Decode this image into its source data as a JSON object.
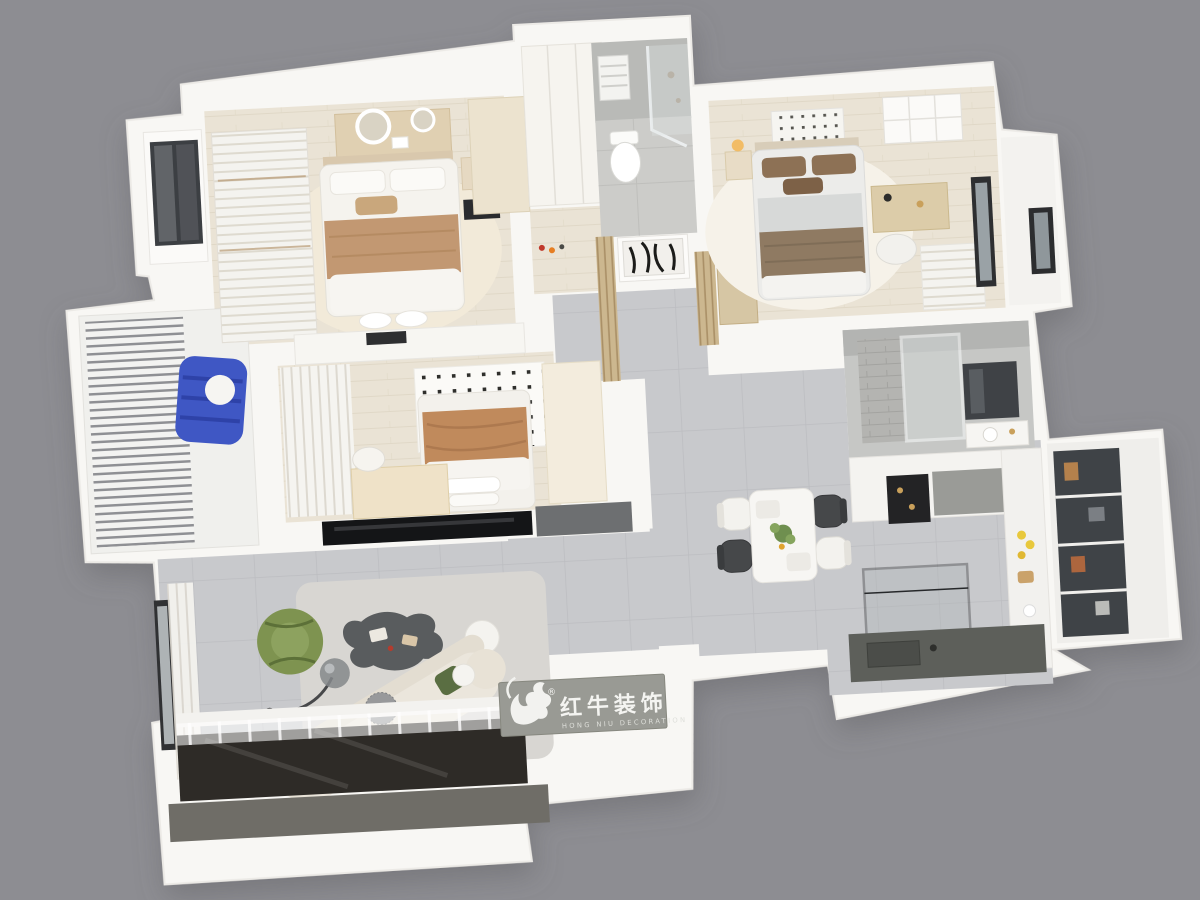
{
  "scene": {
    "type": "3d-floorplan-cutaway-render",
    "view": "top-down isometric",
    "background": "#8d8d92"
  },
  "branding": {
    "logo_zh": "红牛装饰",
    "logo_en": "HONG NIU DECORATION",
    "registered_mark": "®",
    "plaque_color": "#999a94",
    "logo_icon": "bull-swoosh-icon"
  },
  "palette": {
    "wall_white": "#f8f7f4",
    "wood_floor": "#eae3d5",
    "tile_floor": "#c8c9cc",
    "bath_tile": "#bcbdba",
    "living_rug": "#d8d6d2",
    "bedroom_rug": "#f2ead9",
    "tan_blanket": "#c29872",
    "terracotta_blanket": "#c08a5c",
    "brown_blanket": "#8f7a62",
    "blue_chair": "#3f57c4",
    "green_armchair": "#7e9350",
    "sofa_cream": "#ebe6dc",
    "coffee_table": "#595c5e",
    "dark_deck": "#2e2b27",
    "pantry_glass": "#3f4347",
    "deck_skirt": "#6f6d67"
  },
  "rooms": [
    {
      "name": "bedroom-1",
      "position": "top-left",
      "items": [
        "double bed with tan throw",
        "vanity with lighted round mirrors",
        "slatted wardrobe",
        "glass-front closet niche",
        "nightstands with lamps",
        "cream dresser"
      ]
    },
    {
      "name": "closet-hall",
      "position": "top-center",
      "items": [
        "white wardrobe cabinets",
        "display shelf with decor"
      ]
    },
    {
      "name": "bathroom-1",
      "position": "top-center",
      "items": [
        "toilet",
        "glass shower",
        "towel radiator"
      ]
    },
    {
      "name": "entry-hall",
      "position": "center",
      "items": [
        "abstract artwork console",
        "wood slat partitions",
        "shoe cabinet"
      ]
    },
    {
      "name": "bedroom-2",
      "position": "center-left",
      "items": [
        "bed with terracotta throw",
        "perforated headboard panel",
        "cream desk and chair",
        "louver wardrobe",
        "black TV console",
        "gray credenza"
      ]
    },
    {
      "name": "bedroom-3",
      "position": "top-right",
      "items": [
        "bed with brown bedding",
        "ceiling diffuser grid",
        "desk and chair",
        "wall shelf",
        "louver radiator",
        "window"
      ]
    },
    {
      "name": "bay-room",
      "position": "right",
      "items": [
        "window bay"
      ]
    },
    {
      "name": "bathroom-2",
      "position": "mid-right",
      "items": [
        "glass shower with tiled wall",
        "dark mirror cabinet",
        "vanity"
      ]
    },
    {
      "name": "kitchen",
      "position": "bottom-right",
      "items": [
        "glass-door pantry cabinets",
        "counter with lemons and bread",
        "glass partition",
        "dark countertop",
        "display shelf with gold cups",
        "gray-front cabinet"
      ]
    },
    {
      "name": "dining-area",
      "position": "center-right",
      "items": [
        "white dining table",
        "two white chairs",
        "two dark chairs",
        "plant centerpiece"
      ]
    },
    {
      "name": "living-room",
      "position": "bottom-left",
      "items": [
        "curved cream sofa with pillows",
        "green lounge chair",
        "organic dark coffee table",
        "smoked-glass globe floor lamp",
        "white pouf",
        "sheer curtain",
        "window"
      ]
    },
    {
      "name": "balcony-left",
      "position": "left",
      "items": [
        "louver blinds",
        "blue modular lounge chair with white ball cushion"
      ]
    },
    {
      "name": "balcony-bottom",
      "position": "bottom",
      "items": [
        "dark glossy deck",
        "sheer curtain",
        "white step"
      ]
    }
  ]
}
